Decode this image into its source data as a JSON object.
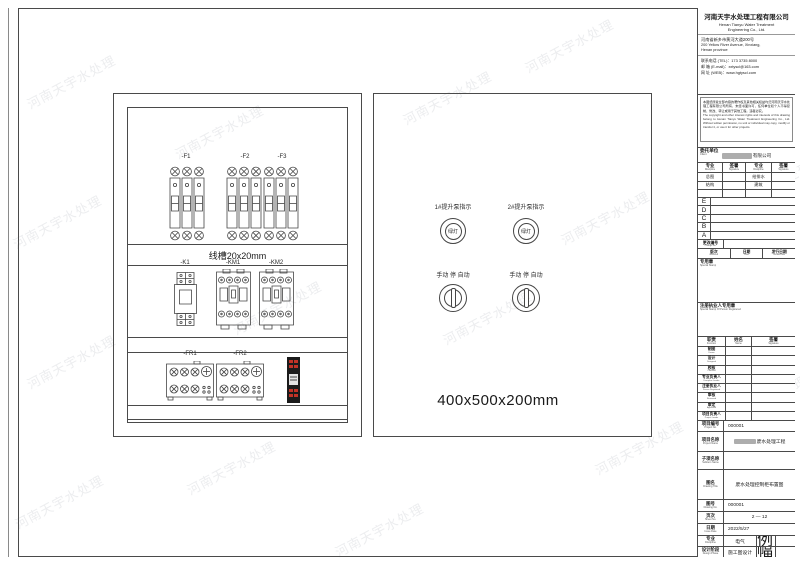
{
  "watermark": "河南天宇水处理",
  "company": {
    "name_cn": "河南天宇水处理工程有限公司",
    "name_en1": "Henan Tianyu Water Treatment",
    "name_en2": "Engineering Co., Ltd.",
    "address_cn": "河南省新乡市黄河大道200号",
    "address_en1": "200 Yellow River Avenue, Xinxiang,",
    "address_en2": "Henan province",
    "tel": "联系电话 (TEL)：173 3735 8000",
    "email": "邮  箱 (E-mail)：xxtyscl@163.com",
    "web": "网  址 (WEB)：www.hgtyscl.com"
  },
  "notice": {
    "cn": "本图纸所载全部内容的著作权及其他相关权益均归河南天宇水处理工程有限公司所有，未经书面许可，任何单位和个人不得复制、修改、转让或用于其他工程，违者必究。",
    "en": "The copyright and other interest rights and interests of this drawing belong to Henan Tianyu Water Treatment Engineering Co., Ltd. Without written permission, no unit or individual may copy, modify or transfer it, or use it for other projects."
  },
  "client": {
    "label": {
      "cn": "委托单位",
      "en": "Client"
    },
    "value_suffix": "有限公司"
  },
  "disc_table": {
    "headers": [
      {
        "cn": "专业",
        "en": "Discipline"
      },
      {
        "cn": "签署",
        "en": "Signature"
      },
      {
        "cn": "专业",
        "en": "Discipline"
      },
      {
        "cn": "签署",
        "en": "Signature"
      }
    ],
    "rows": [
      [
        "总图",
        "",
        "给排水",
        ""
      ],
      [
        "结构",
        "",
        "建筑",
        ""
      ],
      [
        "",
        "",
        "",
        ""
      ]
    ]
  },
  "revisions": [
    "E",
    "D",
    "C",
    "B",
    "A"
  ],
  "change_no": {
    "cn": "更改编号",
    "en": "Change No."
  },
  "rev_row": [
    {
      "cn": "版次",
      "en": "Revision"
    },
    {
      "cn": "日期",
      "en": "Date"
    },
    {
      "cn": "发行日期",
      "en": "Issued Date"
    }
  ],
  "stamps": {
    "special": {
      "cn": "专用章",
      "en": "Special Stamp"
    },
    "registered": {
      "cn": "注册执业人专用章",
      "en": "Special Stamp Of Person Registered"
    }
  },
  "sign_table": {
    "headers": [
      {
        "cn": "职责",
        "en": "Function"
      },
      {
        "cn": "姓名",
        "en": "Name"
      },
      {
        "cn": "签署",
        "en": "Signature"
      }
    ],
    "rows": [
      {
        "cn": "制图",
        "en": "Drawn"
      },
      {
        "cn": "设计",
        "en": "Designed"
      },
      {
        "cn": "校核",
        "en": "Checked"
      },
      {
        "cn": "专业负责人",
        "en": "Discipline Leader"
      },
      {
        "cn": "注册执业人",
        "en": "Person Registered"
      },
      {
        "cn": "审核",
        "en": "Reviewed"
      },
      {
        "cn": "审定",
        "en": "Approved"
      },
      {
        "cn": "项目负责人",
        "en": "Project Leader"
      }
    ]
  },
  "project": {
    "no": {
      "label": {
        "cn": "项目编号",
        "en": "Project No."
      },
      "value": "000001"
    },
    "name": {
      "label": {
        "cn": "项目名称",
        "en": "Project Name"
      },
      "value": "废水处理工程"
    },
    "subitem": {
      "label": {
        "cn": "子项名称",
        "en": "Subitem Name"
      },
      "value": ""
    },
    "title": {
      "label": {
        "cn": "图名",
        "en": "Drawing Title"
      },
      "value": "废水处理控制柜布置图"
    },
    "dwg_no": {
      "label": {
        "cn": "图号",
        "en": "Drawing No."
      },
      "value": "000001"
    },
    "sheet": {
      "label": {
        "cn": "页次",
        "en": "Sheet No."
      },
      "value": "2 — 12"
    },
    "date": {
      "label": {
        "cn": "日期",
        "en": "Issue Date"
      },
      "value": "2022/5/27"
    },
    "discipline": {
      "label": {
        "cn": "专业",
        "en": "Discipline"
      },
      "value": "电气",
      "label2": {
        "cn": "比例",
        "en": "Scale"
      },
      "value2": ""
    },
    "phase": {
      "label": {
        "cn": "设计阶段",
        "en": "Design Phase"
      },
      "value": "施工图设计",
      "label2": {
        "cn": "图幅",
        "en": "Format"
      },
      "value2": ""
    }
  },
  "cabinet": {
    "breaker_labels": [
      "-F1",
      "-F2",
      "-F3"
    ],
    "duct_label": "线槽20x20mm",
    "middle_labels": [
      "-K1",
      "-KM1",
      "-KM2"
    ],
    "bottom_labels": [
      "-FR1",
      "-FR2"
    ],
    "dimension": "400x500x200mm"
  },
  "door": {
    "indicators": [
      {
        "label": "1#提升泵指示",
        "lamp": "绿灯"
      },
      {
        "label": "2#提升泵指示",
        "lamp": "绿灯"
      }
    ],
    "switches": [
      {
        "label": "手动 停 自动"
      },
      {
        "label": "手动 停 自动"
      }
    ]
  }
}
